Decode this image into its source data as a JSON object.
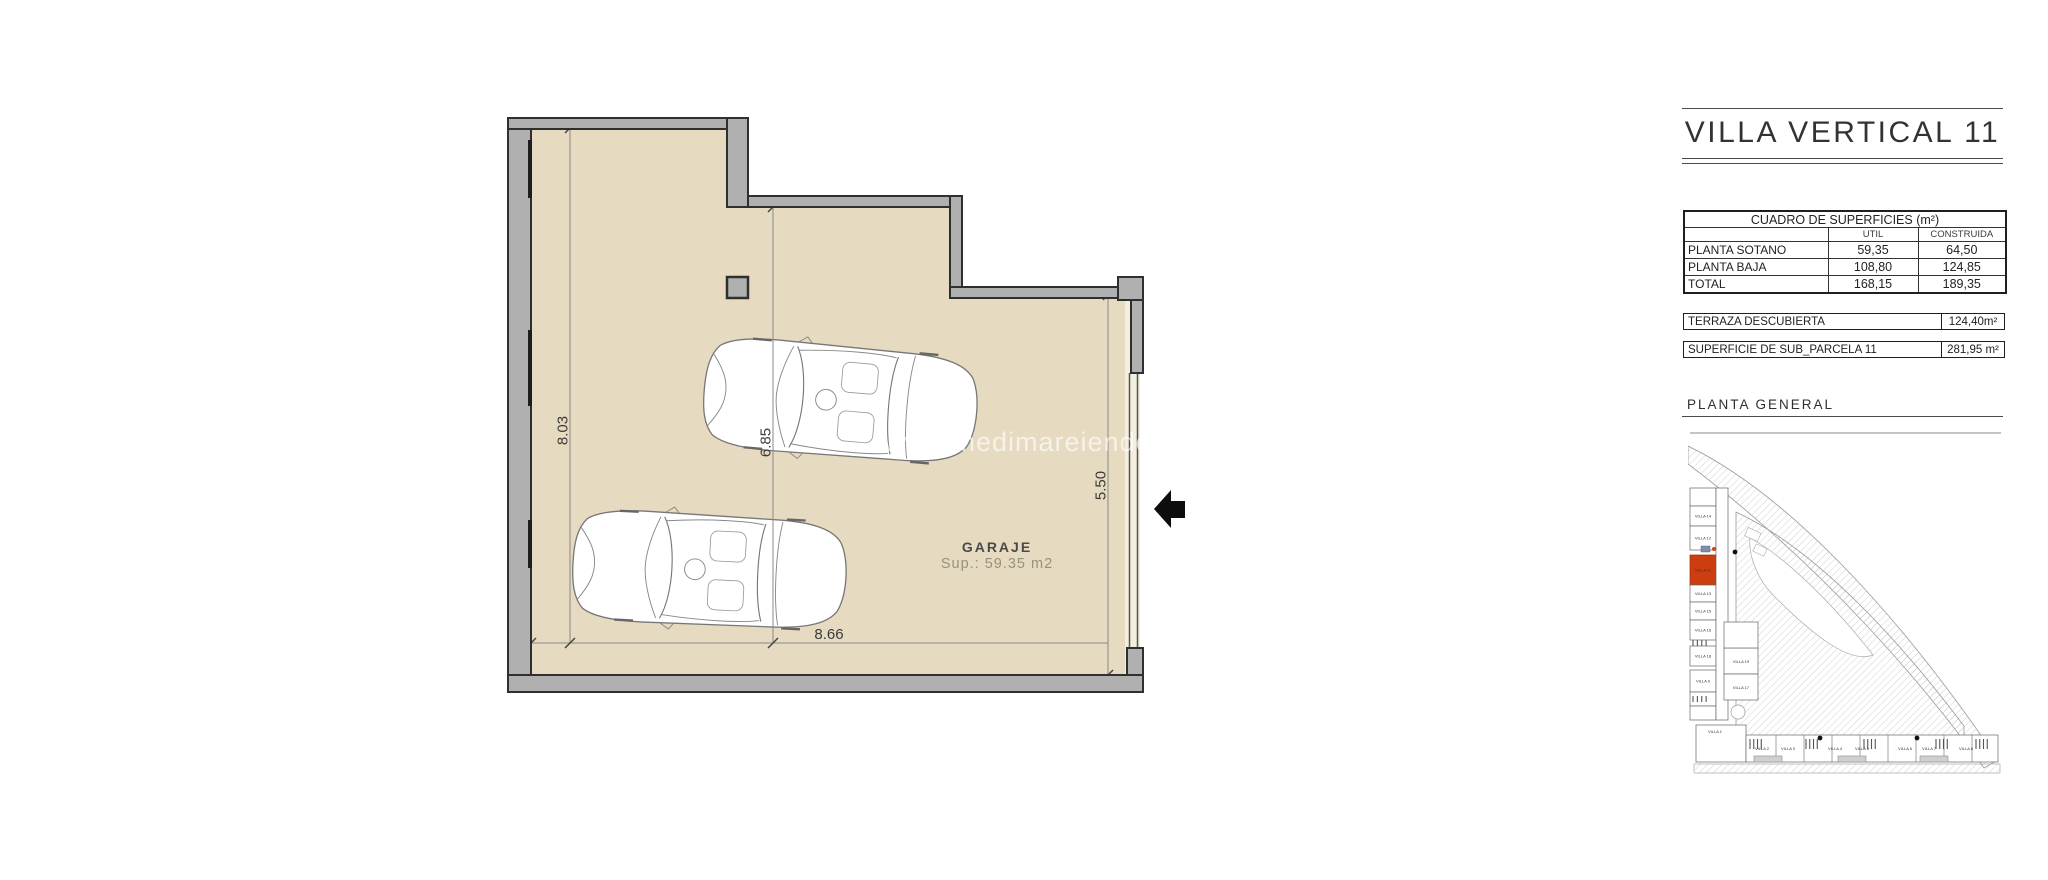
{
  "title_block": {
    "title": "VILLA VERTICAL 11",
    "surfaces_table": {
      "title": "CUADRO DE SUPERFICIES (m²)",
      "col_util": "UTIL",
      "col_construida": "CONSTRUIDA",
      "rows": [
        {
          "label": "PLANTA SOTANO",
          "util": "59,35",
          "construida": "64,50"
        },
        {
          "label": "PLANTA BAJA",
          "util": "108,80",
          "construida": "124,85"
        },
        {
          "label": "TOTAL",
          "util": "168,15",
          "construida": "189,35"
        }
      ]
    },
    "terraza": {
      "label": "TERRAZA DESCUBIERTA",
      "value": "124,40m²"
    },
    "parcela": {
      "label": "SUPERFICIE DE SUB_PARCELA 11",
      "value": "281,95 m²"
    },
    "site_plan_title": "PLANTA GENERAL"
  },
  "floor_plan": {
    "room_label": "GARAJE",
    "room_area": "Sup.: 59.35 m2",
    "dim_left": "8.03",
    "dim_middle": "6.85",
    "dim_right": "5.50",
    "dim_bottom": "8.66",
    "watermark": "www.medimareiendom.co"
  },
  "site_plan": {
    "highlighted_unit": "VILLA 11",
    "left_column": [
      "VILLA 14",
      "VILLA 12",
      "VILLA 11",
      "VILLA 13",
      "VILLA 15",
      "VILLA 16",
      "VILLA 18",
      "VILLA 9"
    ],
    "mid_column": [
      "VILLA 19",
      "VILLA 17"
    ],
    "bottom_row": [
      "VILLA 1",
      "VILLA 2",
      "VILLA 3",
      "VILLA 4",
      "VILLA 5",
      "VILLA 6",
      "VILLA 7",
      "VILLA 8"
    ]
  },
  "colors": {
    "floor": "#e6dbc1",
    "floor_light_strip": "#f3eedd",
    "wall": "#b0b0b0",
    "wall_outline": "#2f2f2f",
    "highlight_red": "#cc3d10",
    "arrow_black": "#0d0d0d"
  }
}
